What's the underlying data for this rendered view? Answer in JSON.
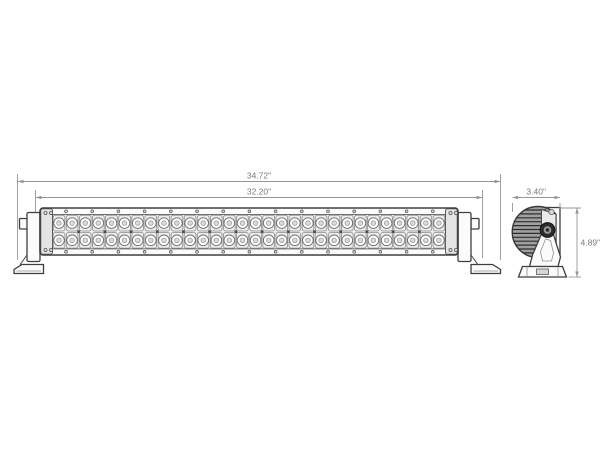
{
  "diagram": {
    "name": "Dual-row LED light bar technical dimension drawing, front view and side profile view",
    "front_view": {
      "overall_width_label": "34.72\"",
      "housing_width_label": "32.20\"",
      "led_columns": 30,
      "led_rows": 2,
      "led_count": 60
    },
    "side_view": {
      "depth_label": "3.40\"",
      "height_label": "4.89\""
    },
    "colors": {
      "outline": "#3f3f3f",
      "dimension": "#969696",
      "dimension_text": "#7a7a7a",
      "fin_shade": "#a0a0a0",
      "background": "#ffffff"
    }
  }
}
